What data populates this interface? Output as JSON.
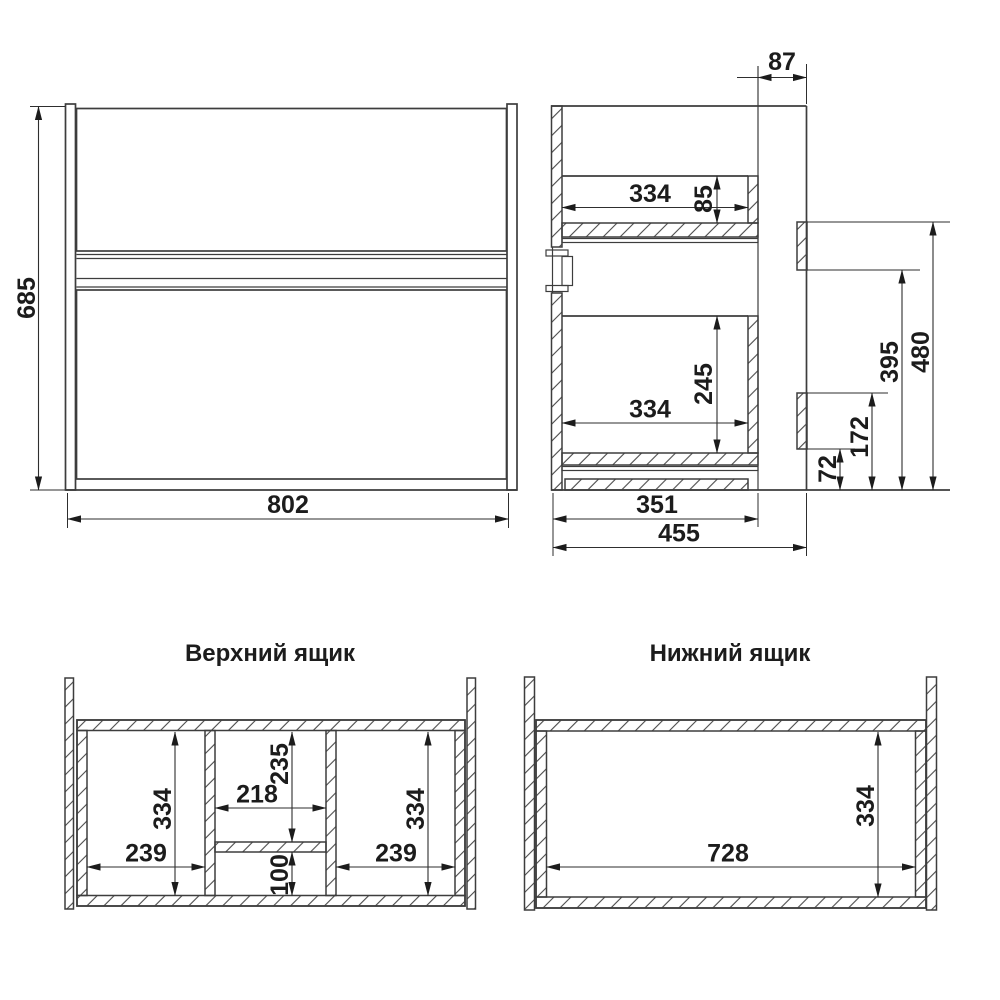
{
  "drawing": {
    "front_view": {
      "height_mm": "685",
      "width_mm": "802"
    },
    "side_view": {
      "back_gap_mm": "87",
      "upper_drawer_depth_mm": "334",
      "upper_drawer_side_height_mm": "85",
      "lower_drawer_depth_mm": "334",
      "lower_drawer_side_height_mm": "245",
      "lower_bracket_bottom_mm": "72",
      "lower_bracket_top_mm": "172",
      "upper_bracket_bottom_mm": "395",
      "upper_bracket_top_mm": "480",
      "drawer_box_depth_mm": "351",
      "total_depth_mm": "455"
    },
    "upper_drawer_view": {
      "title": "Верхний ящик",
      "left_depth_mm": "334",
      "left_width_mm": "239",
      "middle_upper_depth_mm": "235",
      "middle_width_mm": "218",
      "middle_lower_depth_mm": "100",
      "right_depth_mm": "334",
      "right_width_mm": "239"
    },
    "lower_drawer_view": {
      "title": "Нижний ящик",
      "inner_width_mm": "728",
      "inner_depth_mm": "334"
    }
  }
}
